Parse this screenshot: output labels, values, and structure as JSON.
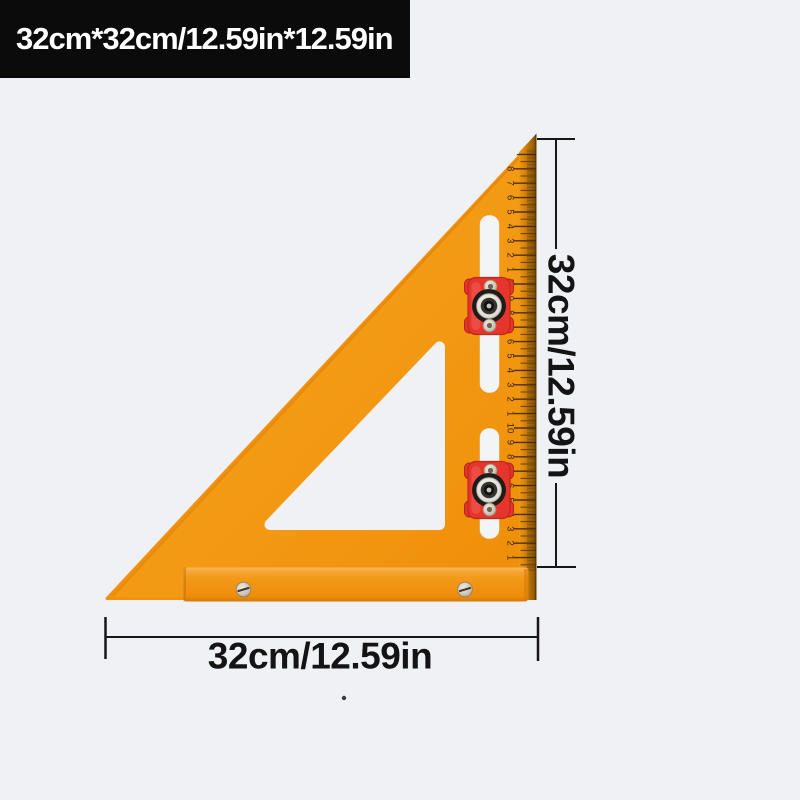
{
  "badge": {
    "text": "32cm*32cm/12.59in*12.59in"
  },
  "dimensions": {
    "right_label": "32cm/12.59in",
    "bottom_label": "32cm/12.59in"
  },
  "ruler": {
    "unit": "cm",
    "numbers": [
      "1",
      "2",
      "3",
      "4",
      "5",
      "6",
      "7",
      "8",
      "9",
      "10",
      "1",
      "2",
      "3",
      "4",
      "5",
      "6",
      "7",
      "8",
      "9",
      "20",
      "1",
      "2",
      "3",
      "4",
      "5",
      "6",
      "7",
      "8"
    ]
  },
  "colors": {
    "background": "#f0f1f4",
    "badge_background": "#0b0b0b",
    "badge_text": "#ffffff",
    "square_orange": "#f2950f",
    "square_orange_light": "#f8a722",
    "ruler_edge_brown": "#8a5708",
    "tick_ink": "#42290a",
    "slider_red": "#e6352c",
    "dimension_ink": "#161616"
  }
}
